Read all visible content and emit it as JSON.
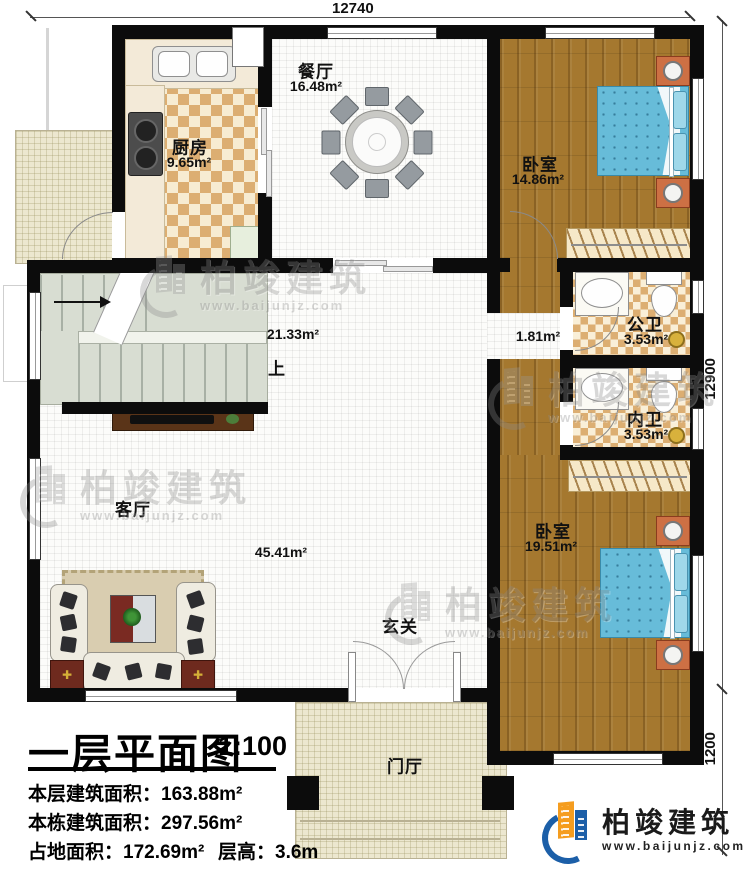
{
  "dimensions": {
    "top": "12740",
    "right": "12900",
    "right_lower": "1200"
  },
  "rooms": {
    "kitchen": {
      "name": "厨房",
      "area": "9.65m²"
    },
    "dining": {
      "name": "餐厅",
      "area": "16.48m²"
    },
    "bedroom1": {
      "name": "卧室",
      "area": "14.86m²"
    },
    "public_bath": {
      "name": "公卫",
      "area": "3.53m²"
    },
    "inner_bath": {
      "name": "内卫",
      "area": "3.53m²"
    },
    "bedroom2": {
      "name": "卧室",
      "area": "19.51m²"
    },
    "living": {
      "name": "客厅",
      "area": "45.41m²"
    },
    "hall": {
      "area": "21.33m²"
    },
    "corridor": {
      "area": "1.81m²"
    },
    "stairs": {
      "up_label": "上"
    },
    "entry": {
      "name": "玄关"
    },
    "porch": {
      "name": "门厅"
    }
  },
  "title_block": {
    "title": "一层平面图",
    "scale": "1:100",
    "floor_area_line": "本层建筑面积：163.88m²",
    "building_area_line": "本栋建筑面积：297.56m²",
    "land_area_line": "占地面积：172.69m²",
    "height_line": "层高：3.6m"
  },
  "watermark": {
    "name": "柏竣建筑",
    "url": "www.baijunjz.com"
  },
  "logo": {
    "name": "柏竣建筑",
    "url": "www.baijunjz.com"
  }
}
